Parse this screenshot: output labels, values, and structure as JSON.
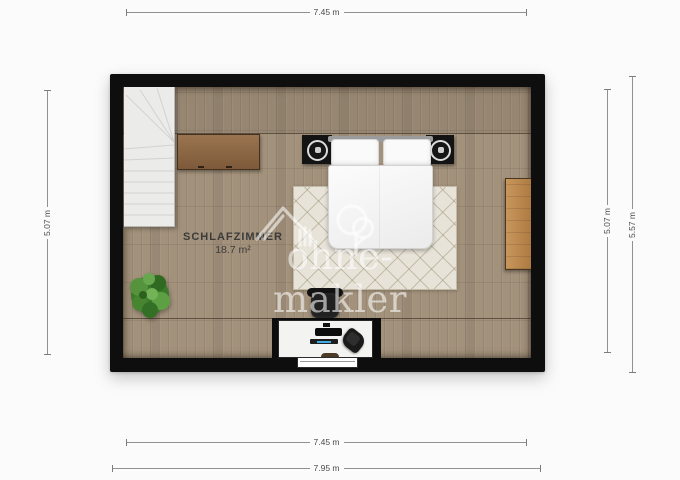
{
  "floorplan": {
    "room_label": "SCHLAFZIMMER",
    "room_area": "18.7 m²",
    "watermark_text": "ohne-makler",
    "dimensions": {
      "top_width": "7.45 m",
      "bottom_width_inner": "7.45 m",
      "bottom_width_outer": "7.95 m",
      "left_height": "5.07 m",
      "right_height_inner": "5.07 m",
      "right_height_outer": "5.57 m"
    },
    "colors": {
      "wall": "#0e0e0e",
      "floor_wood": "#a2917b",
      "rug": "#e8e3d8",
      "sideboard_wood": "#8a6645",
      "wardrobe_wood": "#bb8850",
      "plant_green": "#4e8f3a",
      "keyboard_accent": "#3fa9e0",
      "watermark_white": "rgba(255,255,255,0.58)",
      "page_background": "#fbfbfb"
    }
  }
}
